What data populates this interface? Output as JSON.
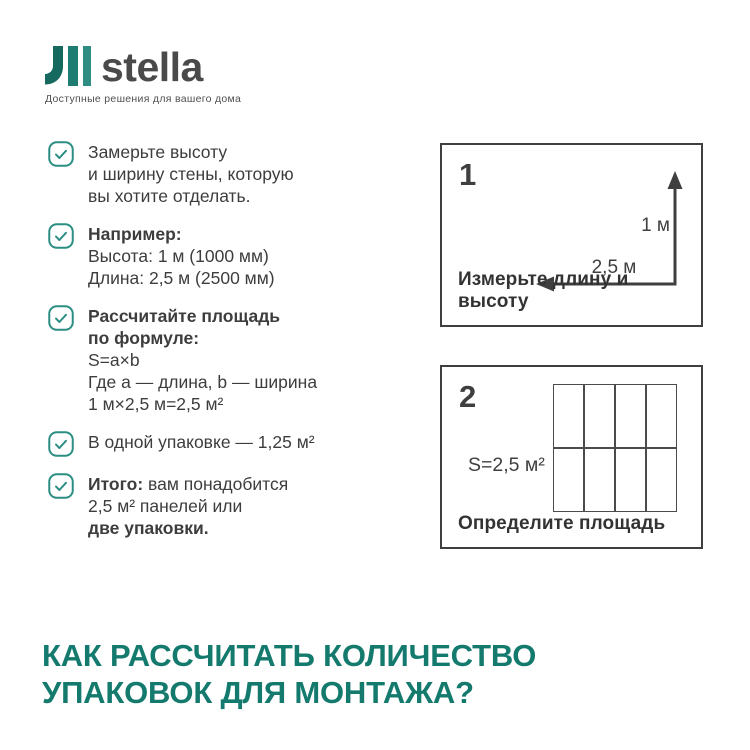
{
  "theme": {
    "accent_teal": "#147A6E",
    "checkbox_teal": "#2B8E83",
    "text_dark": "#3D3D3D",
    "line_dark": "#3F3F3F",
    "logo_dark": "#15695F",
    "logo_mid": "#1E7C72",
    "logo_light": "#2E8C82",
    "logo_text_gray": "#4A4A4A",
    "background": "#FFFFFF"
  },
  "brand": {
    "name": "stella",
    "tagline": "Доступные решения для вашего дома"
  },
  "checklist": {
    "items": [
      {
        "lines": [
          [
            {
              "t": "Замерьте высоту"
            }
          ],
          [
            {
              "t": "и ширину стены, которую"
            }
          ],
          [
            {
              "t": "вы хотите отделать."
            }
          ]
        ]
      },
      {
        "lines": [
          [
            {
              "t": "Например:",
              "b": true
            }
          ],
          [
            {
              "t": "Высота: 1 м (1000 мм)"
            }
          ],
          [
            {
              "t": "Длина: 2,5 м (2500 мм)"
            }
          ]
        ]
      },
      {
        "lines": [
          [
            {
              "t": "Рассчитайте площадь",
              "b": true
            }
          ],
          [
            {
              "t": "по формуле:",
              "b": true
            }
          ],
          [
            {
              "t": "S=a×b"
            }
          ],
          [
            {
              "t": "Где a — длина, b — ширина"
            }
          ],
          [
            {
              "t": "1 м×2,5 м=2,5 м²"
            }
          ]
        ]
      },
      {
        "lines": [
          [
            {
              "t": "В одной упаковке — 1,25 м²"
            }
          ]
        ]
      },
      {
        "lines": [
          [
            {
              "t": "Итого:",
              "b": true
            },
            {
              "t": " вам понадобится"
            }
          ],
          [
            {
              "t": "2,5 м² панелей или"
            }
          ],
          [
            {
              "t": "две упаковки.",
              "b": true
            }
          ]
        ]
      }
    ]
  },
  "figures": [
    {
      "number": "1",
      "caption": "Измерьте длину и высоту",
      "height_label": "1 м",
      "width_label": "2,5 м"
    },
    {
      "number": "2",
      "caption": "Определите площадь",
      "area_label": "S=2,5 м²",
      "grid": {
        "cols": 4,
        "rows": 2
      }
    }
  ],
  "heading": {
    "line1": "КАК РАССЧИТАТЬ КОЛИЧЕСТВО",
    "line2": "УПАКОВОК ДЛЯ МОНТАЖА?"
  }
}
